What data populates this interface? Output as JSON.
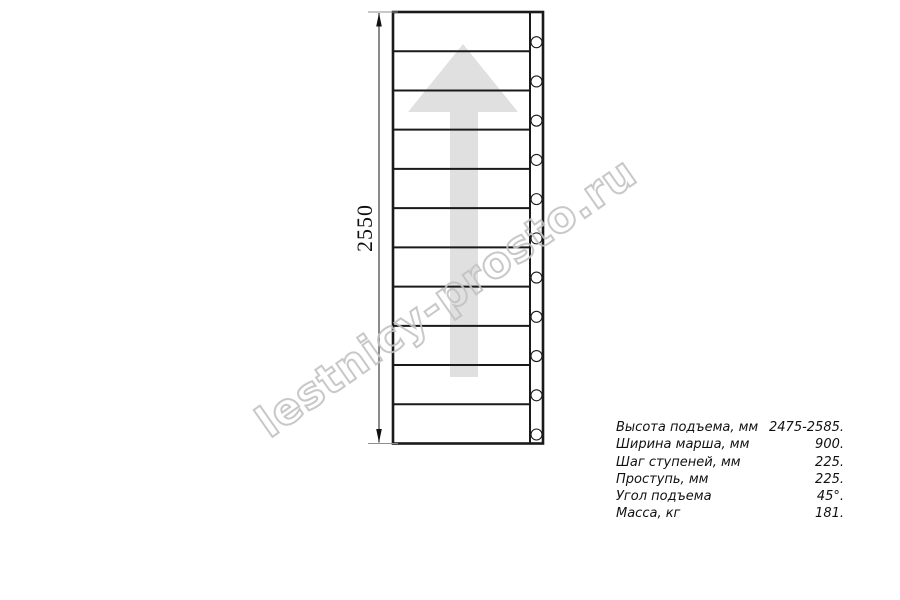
{
  "drawing": {
    "dimension_label": "2550",
    "tread_count": 11,
    "bolt_count": 11
  },
  "watermark": {
    "text": "lestnicy-prosto.ru"
  },
  "specs": {
    "rows": [
      {
        "label": "Высота подъема, мм",
        "value": "2475-2585."
      },
      {
        "label": "Ширина марша, мм",
        "value": "900."
      },
      {
        "label": "Шаг ступеней, мм",
        "value": "225."
      },
      {
        "label": "Проступь, мм",
        "value": "225."
      },
      {
        "label": "Угол подъема",
        "value": "45°."
      },
      {
        "label": "Масса, кг",
        "value": "181."
      }
    ]
  },
  "colors": {
    "line": "#1a1a1a",
    "arrow_fill": "#e0e0e0",
    "watermark": "#c2c2c2"
  }
}
